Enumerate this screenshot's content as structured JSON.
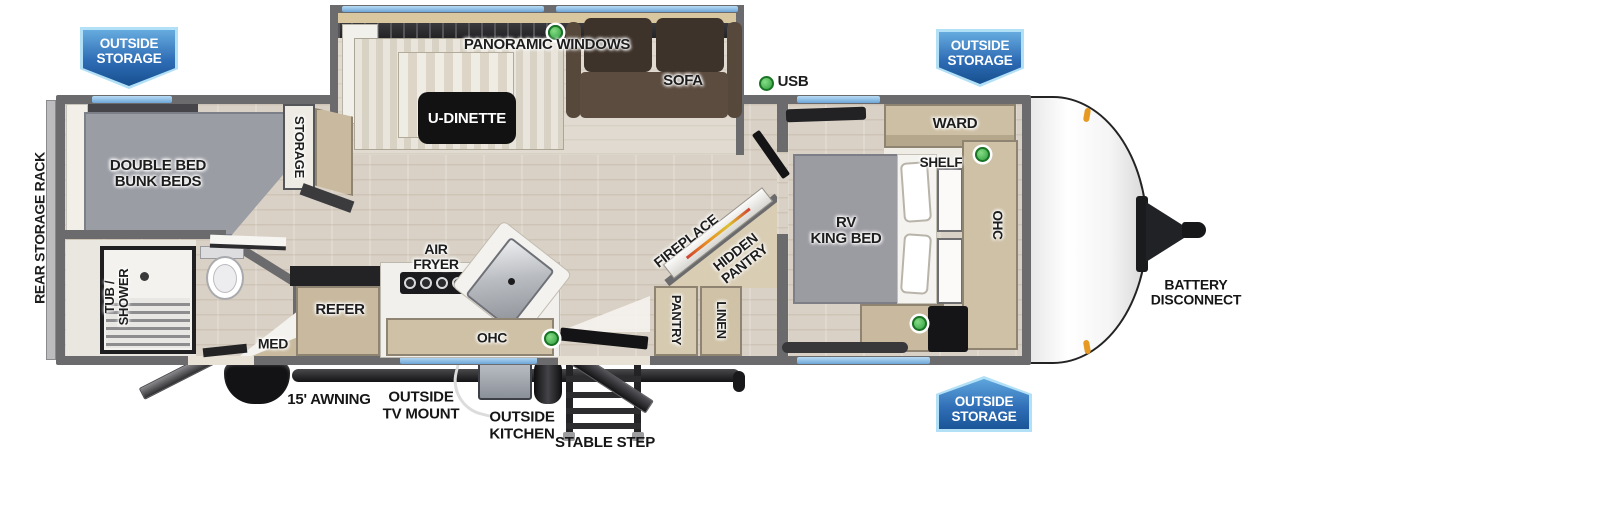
{
  "badges": {
    "top_left": {
      "text": "OUTSIDE\nSTORAGE"
    },
    "top_right": {
      "text": "OUTSIDE\nSTORAGE"
    },
    "bottom_right": {
      "text": "OUTSIDE\nSTORAGE"
    }
  },
  "labels": {
    "rear_storage_rack": "REAR STORAGE RACK",
    "panoramic_windows": "PANORAMIC WINDOWS",
    "u_dinette": "U-DINETTE",
    "sofa": "SOFA",
    "usb": "USB",
    "storage": "STORAGE",
    "bunk_beds": "DOUBLE BED\nBUNK BEDS",
    "ward": "WARD",
    "shelf": "SHELF",
    "rv_king_bed": "RV\nKING BED",
    "ohc_bedroom": "OHC",
    "fireplace": "FIREPLACE",
    "hidden_pantry": "HIDDEN\nPANTRY",
    "pantry": "PANTRY",
    "linen": "LINEN",
    "air_fryer": "AIR\nFRYER",
    "refer": "REFER",
    "ohc_kitchen": "OHC",
    "med": "MED",
    "tub_shower": "TUB /\nSHOWER",
    "battery_disconnect": "BATTERY\nDISCONNECT",
    "awning": "15' AWNING",
    "outside_tv_mount": "OUTSIDE\nTV MOUNT",
    "outside_kitchen": "OUTSIDE\nKITCHEN",
    "stable_step": "STABLE STEP"
  },
  "colors": {
    "banner_blue_dark": "#1a5597",
    "banner_blue_light": "#66abdf",
    "banner_border": "#b2e0f6",
    "wall_gray": "#6b6b6d",
    "floor_tan": "#d9d1c5",
    "cabinet_wood": "#c9ba9f",
    "bed_gray": "#9b9ba2",
    "sofa_brown": "#4a3c31",
    "window_blue": "#8ec4ec",
    "usb_green": "#3db54b"
  }
}
